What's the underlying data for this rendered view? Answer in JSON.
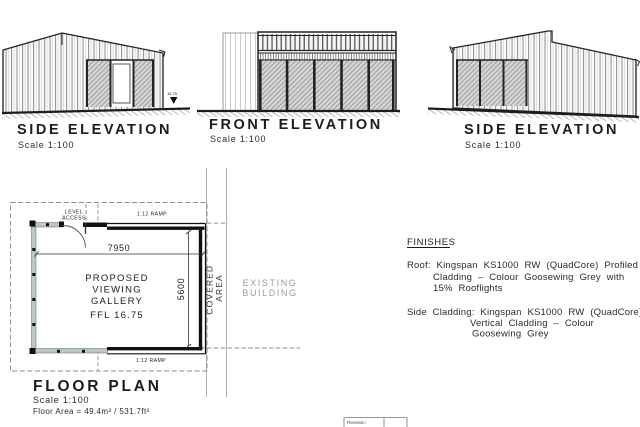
{
  "elevation_side_left": {
    "title": "SIDE ELEVATION",
    "scale": "Scale 1:100",
    "level_marker": "16.75"
  },
  "elevation_front": {
    "title": "FRONT ELEVATION",
    "scale": "Scale 1:100"
  },
  "elevation_side_right": {
    "title": "SIDE ELEVATION",
    "scale": "Scale 1:100"
  },
  "floor_plan": {
    "title": "FLOOR PLAN",
    "scale": "Scale 1:100",
    "area": "Floor Area = 49.4m² / 531.7ft²",
    "room": [
      "PROPOSED",
      "VIEWING",
      "GALLERY"
    ],
    "ffl": "FFL 16.75",
    "width_dim": "7950",
    "depth_dim": "5600",
    "ramp_top": "1:12 RAMP",
    "ramp_bottom": "1:12 RAMP",
    "level_access": [
      "LEVEL",
      "ACCESS"
    ],
    "covered_area": [
      "COVERED",
      "AREA"
    ],
    "existing_building": [
      "EXISTING",
      "BUILDING"
    ]
  },
  "finishes": {
    "heading": "FINISHES",
    "roof": [
      "Roof: Kingspan KS1000 RW (QuadCore) Profiled",
      "Cladding – Colour Goosewing Grey with",
      "15% Rooflights"
    ],
    "side": [
      "Side Cladding: Kingspan KS1000 RW (QuadCore)",
      "Vertical Cladding – Colour",
      "Goosewing Grey"
    ]
  },
  "title_block": {
    "revision": "Revision:"
  },
  "colors": {
    "line": "#1c1c1c",
    "plan_glazing": "#b9c8c1",
    "grey_text": "#9b9b9b",
    "construction_line": "#b0b0b0"
  }
}
